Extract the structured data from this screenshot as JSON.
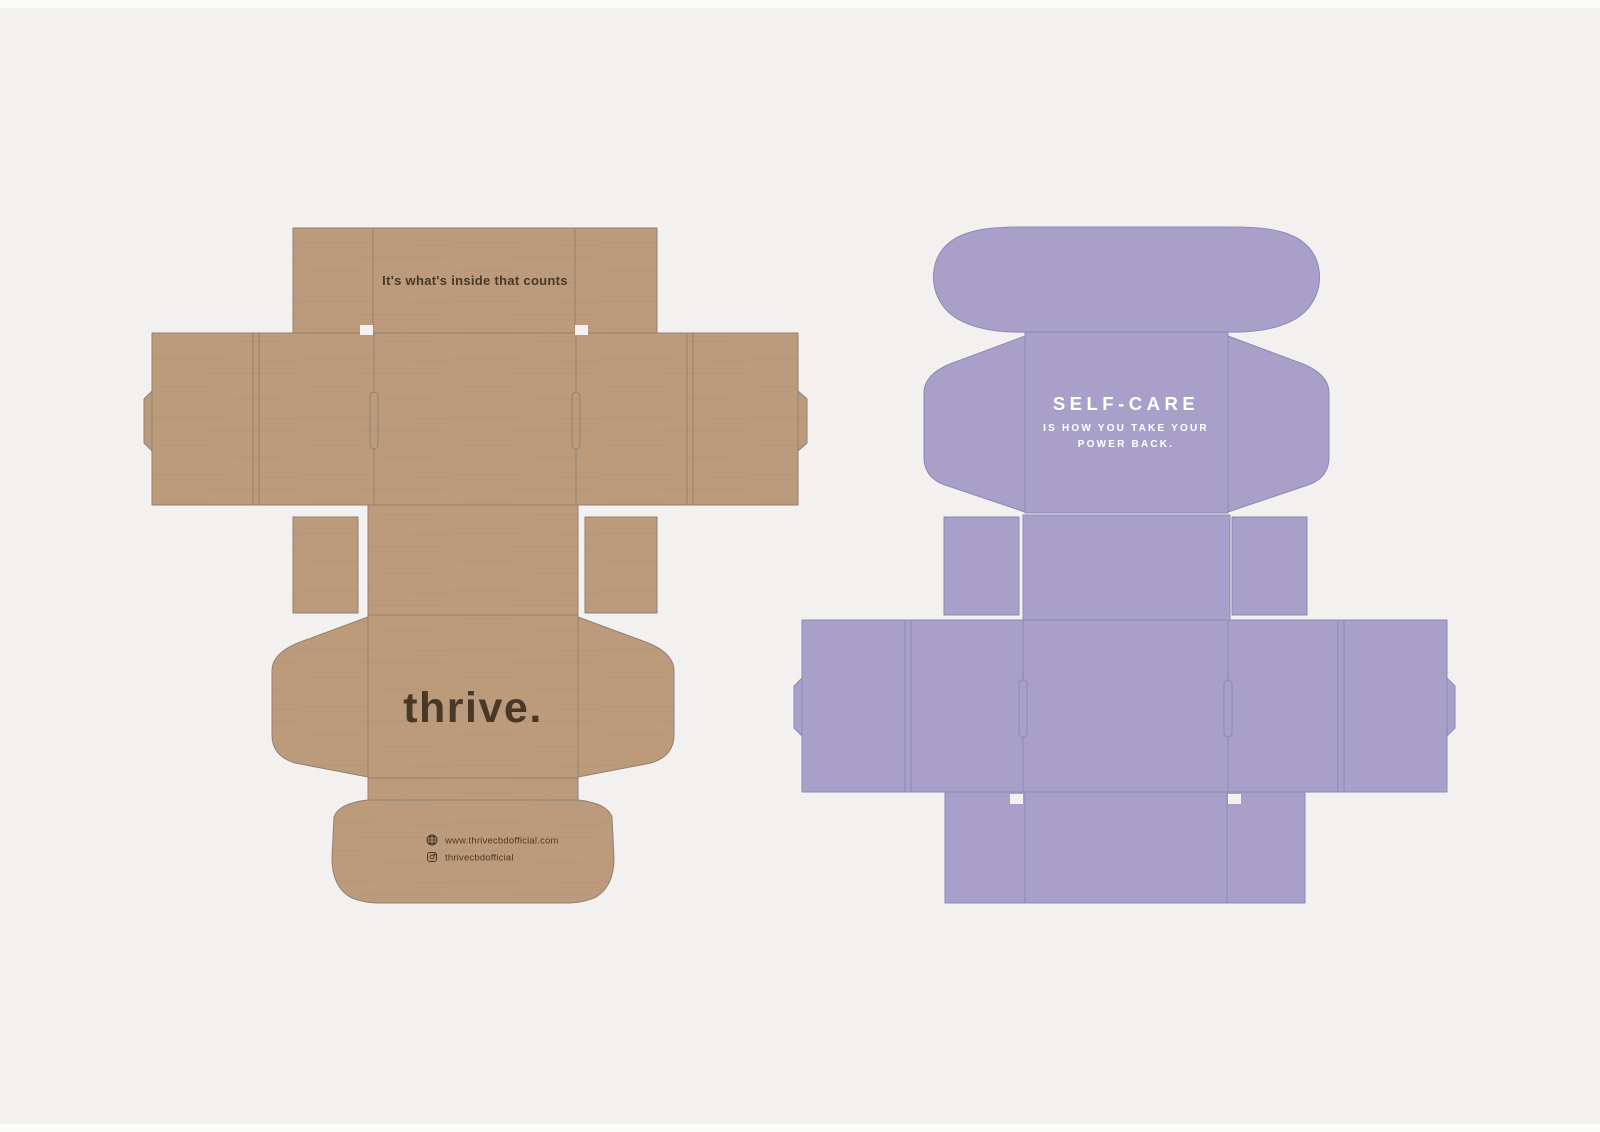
{
  "page": {
    "background": "#f2f1ef",
    "margin_strip_color": "#fbfbfa"
  },
  "kraft_dieline": {
    "label": "kraft mailer box dieline",
    "board_color": "#bb9b7c",
    "board_speckle_color": "#ab8b6d",
    "line_color": "#93806f",
    "ink_color": "#4a3827",
    "top_flap_quote": "It's what's inside that counts",
    "logo": "thrive.",
    "website_url": "www.thrivecbdofficial.com",
    "instagram_handle": "thrivecbdofficial"
  },
  "purple_dieline": {
    "label": "purple mailer box dieline",
    "board_color": "#a9a0c9",
    "line_color": "#8f87b8",
    "ink_color": "#ffffff",
    "headline": "SELF-CARE",
    "tagline_line1": "IS HOW YOU TAKE YOUR",
    "tagline_line2": "POWER BACK."
  }
}
